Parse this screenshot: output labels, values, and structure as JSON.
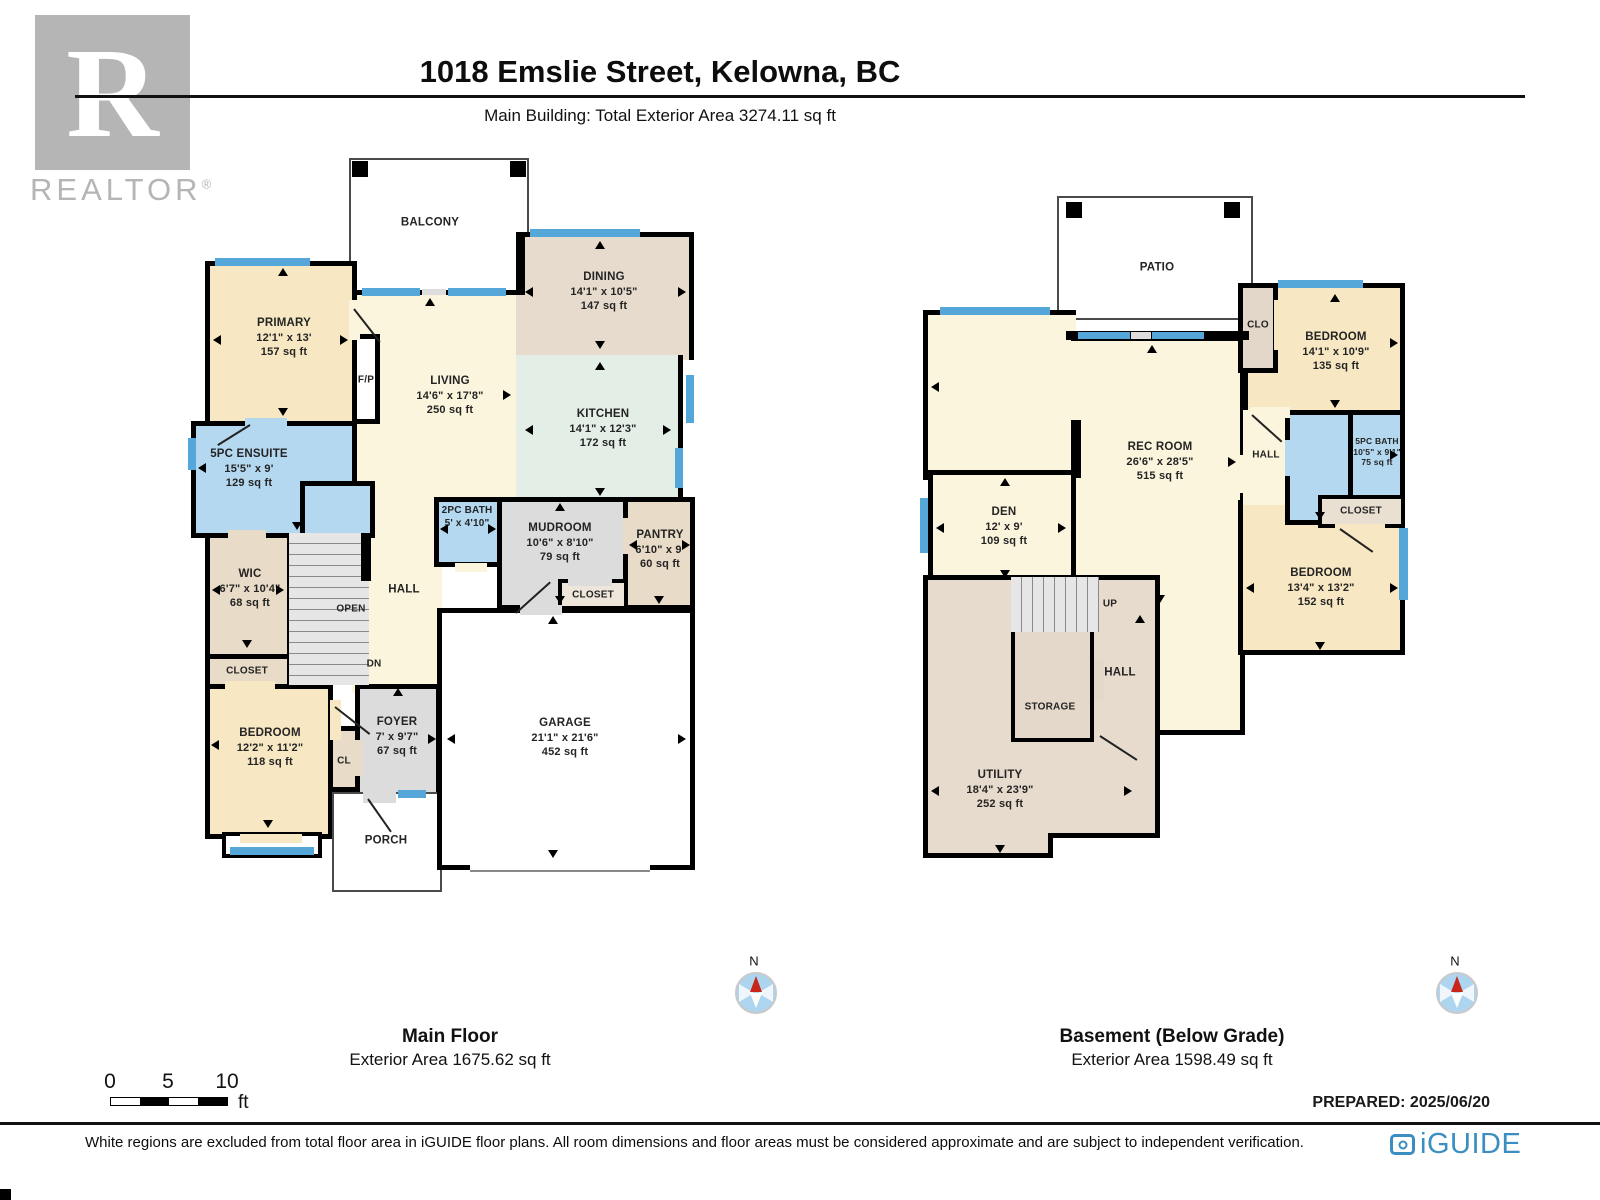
{
  "header": {
    "title": "1018 Emslie Street, Kelowna, BC",
    "subtitle": "Main Building: Total Exterior Area 3274.11 sq ft"
  },
  "realtor_logo": {
    "letter": "R",
    "wordmark": "REALTOR",
    "registered": "®"
  },
  "floors": [
    {
      "title": "Main Floor",
      "area_label": "Exterior Area 1675.62 sq ft",
      "rooms": {
        "balcony": {
          "name": "BALCONY"
        },
        "primary": {
          "name": "PRIMARY",
          "dims": "12'1\" x 13'",
          "area": "157 sq ft"
        },
        "dining": {
          "name": "DINING",
          "dims": "14'1\" x 10'5\"",
          "area": "147 sq ft"
        },
        "living": {
          "name": "LIVING",
          "dims": "14'6\" x 17'8\"",
          "area": "250 sq ft"
        },
        "kitchen": {
          "name": "KITCHEN",
          "dims": "14'1\" x 12'3\"",
          "area": "172 sq ft"
        },
        "fp": {
          "name": "F/P"
        },
        "ensuite": {
          "name": "5PC ENSUITE",
          "dims": "15'5\" x 9'",
          "area": "129 sq ft"
        },
        "bath2": {
          "name": "2PC BATH",
          "dims": "5' x 4'10\""
        },
        "mudroom": {
          "name": "MUDROOM",
          "dims": "10'6\" x 8'10\"",
          "area": "79 sq ft"
        },
        "pantry": {
          "name": "PANTRY",
          "dims": "6'10\" x 9'",
          "area": "60 sq ft"
        },
        "closet_mud": {
          "name": "CLOSET"
        },
        "wic": {
          "name": "WIC",
          "dims": "6'7\" x 10'4\"",
          "area": "68 sq ft"
        },
        "hall": {
          "name": "HALL"
        },
        "open": {
          "name": "OPEN"
        },
        "dn": {
          "name": "DN"
        },
        "closet": {
          "name": "CLOSET"
        },
        "bedroom": {
          "name": "BEDROOM",
          "dims": "12'2\" x 11'2\"",
          "area": "118 sq ft"
        },
        "cl": {
          "name": "CL"
        },
        "foyer": {
          "name": "FOYER",
          "dims": "7' x 9'7\"",
          "area": "67 sq ft"
        },
        "garage": {
          "name": "GARAGE",
          "dims": "21'1\" x 21'6\"",
          "area": "452 sq ft"
        },
        "porch": {
          "name": "PORCH"
        }
      }
    },
    {
      "title": "Basement (Below Grade)",
      "area_label": "Exterior Area 1598.49 sq ft",
      "rooms": {
        "patio": {
          "name": "PATIO"
        },
        "clo": {
          "name": "CLO"
        },
        "bedroom1": {
          "name": "BEDROOM",
          "dims": "14'1\" x 10'9\"",
          "area": "135 sq ft"
        },
        "rec_room": {
          "name": "REC ROOM",
          "dims": "26'6\" x 28'5\"",
          "area": "515 sq ft"
        },
        "hall_upper": {
          "name": "HALL"
        },
        "bath": {
          "name": "5PC BATH",
          "dims": "10'5\" x 9'1\"",
          "area": "75 sq ft"
        },
        "closet": {
          "name": "CLOSET"
        },
        "bedroom2": {
          "name": "BEDROOM",
          "dims": "13'4\" x 13'2\"",
          "area": "152 sq ft"
        },
        "den": {
          "name": "DEN",
          "dims": "12' x 9'",
          "area": "109 sq ft"
        },
        "up": {
          "name": "UP"
        },
        "storage": {
          "name": "STORAGE"
        },
        "hall": {
          "name": "HALL"
        },
        "utility": {
          "name": "UTILITY",
          "dims": "18'4\" x 23'9\"",
          "area": "252 sq ft"
        }
      }
    }
  ],
  "compass": {
    "label": "N"
  },
  "scale_bar": {
    "ticks": [
      "0",
      "5",
      "10"
    ],
    "unit": "ft"
  },
  "prepared": "PREPARED: 2025/06/20",
  "footer": {
    "disclaimer": "White regions are excluded from total floor area in iGUIDE floor plans. All room dimensions and floor areas must be considered approximate and are subject to independent verification."
  },
  "iguide": {
    "wordmark": "iGUIDE"
  },
  "colors": {
    "wall": "#000000",
    "window": "#55a7d9",
    "room_cream": "#fcf5dd",
    "room_wheat": "#f7e8c3",
    "room_tan": "#e8dbc7",
    "room_taupe": "#e7dbcd",
    "room_gray": "#dcdcdc",
    "room_blue": "#b4d8f0",
    "room_mint": "#e2eee6",
    "stairs": "#e6e6e6",
    "compass_fill": "#aed5ef",
    "compass_needle": "#c9261b",
    "iguide_blue": "#3b8ec2",
    "realtor_gray": "#b5b5b5"
  }
}
